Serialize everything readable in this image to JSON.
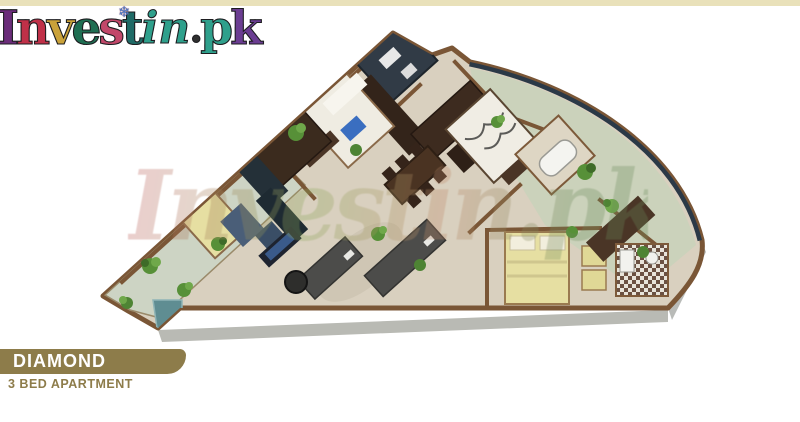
{
  "page": {
    "background": "#ffffff",
    "top_band_color": "#e9e1ba"
  },
  "logo": {
    "text": "Investin.pk",
    "ornament": "snowflake",
    "ornament_glyph": "❄",
    "letters": [
      {
        "ch": "I",
        "color": "#6b2d7a"
      },
      {
        "ch": "n",
        "color": "#c03048"
      },
      {
        "ch": "v",
        "color": "#caa23a"
      },
      {
        "ch": "e",
        "color": "#1f6e52"
      },
      {
        "ch": "s",
        "color": "#c2486a"
      },
      {
        "ch": "t",
        "color": "#1f6a66"
      },
      {
        "ch": "i",
        "color": "#2fa08c"
      },
      {
        "ch": "n",
        "color": "#2fa08c"
      },
      {
        "ch": ".",
        "color": "#303030"
      },
      {
        "ch": "p",
        "color": "#2fa08c"
      },
      {
        "ch": "k",
        "color": "#6b3d92"
      }
    ]
  },
  "watermark": {
    "text": "Investin.pk",
    "opacity": 0.3
  },
  "floor_plan": {
    "type": "3d-isometric-floor-plan",
    "rooms": [
      "bedroom-1",
      "bathroom-1",
      "wardrobe",
      "bedroom-2",
      "bathroom-2",
      "kitchen",
      "dining-area",
      "living-room",
      "master-bedroom",
      "master-bathroom",
      "terrace",
      "balcony",
      "lift-shaft"
    ],
    "colors": {
      "floor": "#d9d0bf",
      "walls": "#7a5636",
      "dark_wood": "#3b2b1e",
      "sofa": "#4c4c4a",
      "bed_yellow": "#e6dfa2",
      "bed_white": "#efece2",
      "plants": "#579038",
      "glass_rail": "#2b3947",
      "terrace_floor": "#c9d1ba",
      "balcony_floor": "#cdd4c4",
      "kitchen_counter": "#243038"
    }
  },
  "footer": {
    "plan_name": "DIAMOND",
    "plan_type": "3 BED APARTMENT",
    "band_color": "#8d7c4a",
    "subtitle_color": "#8d7c4a",
    "name_color": "#ffffff"
  }
}
